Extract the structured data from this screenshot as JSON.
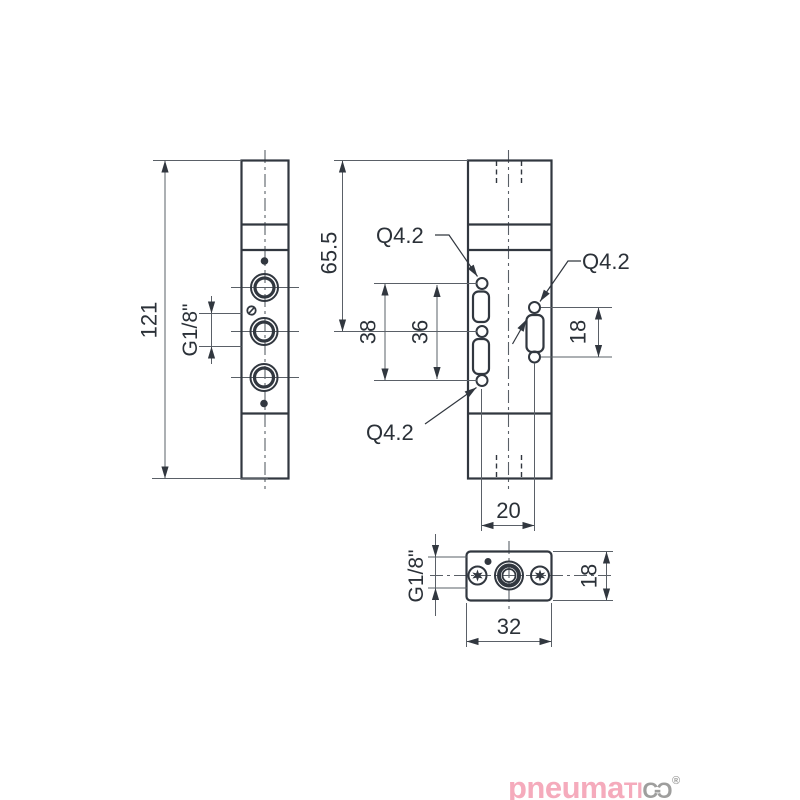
{
  "drawing_title": "Pneumatic valve body dimensional drawing",
  "colors": {
    "outline": "#31373F",
    "thin_line": "#5A6067",
    "text": "#2B3138",
    "logo_pink": "#F5ABBC",
    "logo_gray": "#9E9E9D"
  },
  "front_view": {
    "height_label": "121",
    "thread_label": "G1/8\""
  },
  "side_view": {
    "top_height_label": "65.5",
    "outer_span_label": "38",
    "inner_span_label": "36",
    "right_span_label": "18",
    "width_label": "20",
    "hole_label_top": "Q4.2",
    "hole_label_right": "Q4.2",
    "hole_label_bottom": "Q4.2"
  },
  "bottom_view": {
    "width_label": "32",
    "depth_label": "18",
    "thread_label": "G1/8\""
  },
  "logo": {
    "word_main": "pneuma",
    "word_caps": "TI",
    "letter_c": "C",
    "connector": "-",
    "letter_o": "Ɔ",
    "registered": "®"
  }
}
